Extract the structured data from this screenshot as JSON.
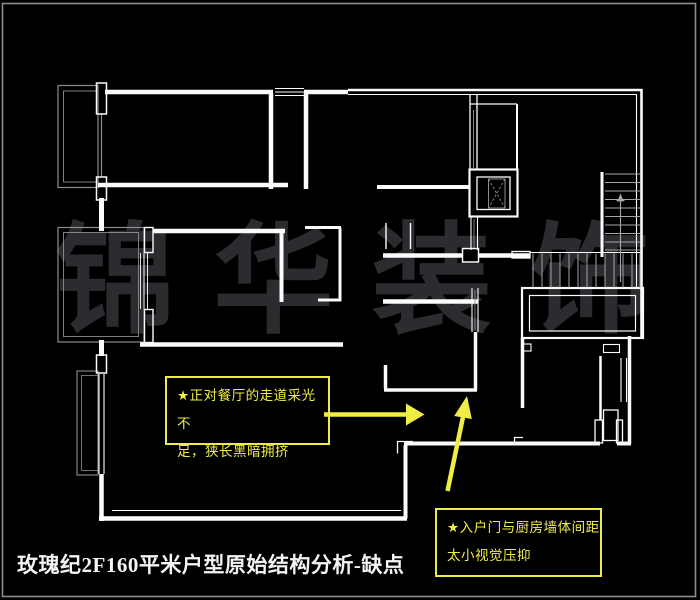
{
  "canvas": {
    "background": "#000000",
    "frame_color": "#9a9a9a"
  },
  "watermark": {
    "chars": [
      "锦",
      "华",
      "装",
      "饰"
    ],
    "color": "#2b2b30"
  },
  "title": {
    "text": "玫瑰纪2F160平米户型原始结构分析-缺点",
    "color": "#f4f4f4"
  },
  "annotations": {
    "accent_color": "#efed45",
    "corridor_note": {
      "line1": "★正对餐厅的走道采光不",
      "line2": "足，狭长黑暗拥挤"
    },
    "entry_note": {
      "line1": "★入户门与厨房墙体间距",
      "line2": "太小视觉压抑"
    }
  },
  "floor_plan": {
    "wall_color": "#fbfbfb",
    "glass_color": "#8e8e8e",
    "stair_color": "#a6a6a6",
    "features": [
      "bedrooms",
      "living-room",
      "corridor",
      "kitchen",
      "elevator",
      "staircase",
      "balconies",
      "entry-door"
    ]
  }
}
